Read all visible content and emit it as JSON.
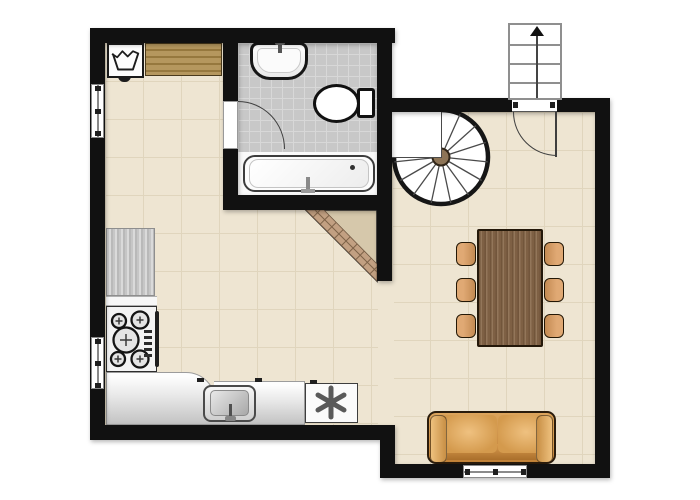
{
  "canvas": {
    "width": 700,
    "height": 500,
    "background": "#ffffff"
  },
  "palette": {
    "wall": "#111111",
    "floor": "#eee5d2",
    "floor_grid": "#e0d5bd",
    "bathroom_tile": "#c8c8c8",
    "bathroom_tile_grid": "#d8d8d8",
    "wood_shelf": "#b5975e",
    "dining_table_wood": "#8a6a4c",
    "chair": "#d89e6d",
    "sofa": "#dca45c",
    "counter": "#cdcdcd",
    "spiral_stair_hub": "#8d7456",
    "chimney_band": "#c2a082",
    "chimney_fill": "#d6c8ab"
  },
  "items": {
    "washing_machine": "washing machine",
    "laundry_icon": "laundry tub symbol",
    "wooden_shelf": "wooden shelf / worktop",
    "bathroom": "bathroom",
    "bathroom_sink": "bathroom wash basin",
    "toilet": "toilet",
    "bathtub": "bathtub",
    "bathroom_door": "bathroom door with swing arc",
    "kitchen_counter_left": "kitchen counter (left wall)",
    "stove": "cooker with four burners and oven",
    "kitchen_counter_bottom": "kitchen worktop (bottom wall)",
    "kitchen_sink": "kitchen sink",
    "asterisk_appliance": "appliance marked with asterisk symbol",
    "dining_table": "dining table",
    "dining_chair": "dining chair",
    "sofa": "two-seat sofa",
    "spiral_staircase": "spiral staircase",
    "entrance_stairs": "entrance steps with up arrow",
    "entrance_door": "entrance door with swing arc",
    "window_left_upper": "window (left wall, upper)",
    "window_left_lower": "window (left wall, lower)",
    "window_bottom": "window (bottom wall)",
    "chimney": "diagonal chimney / flue structure"
  }
}
